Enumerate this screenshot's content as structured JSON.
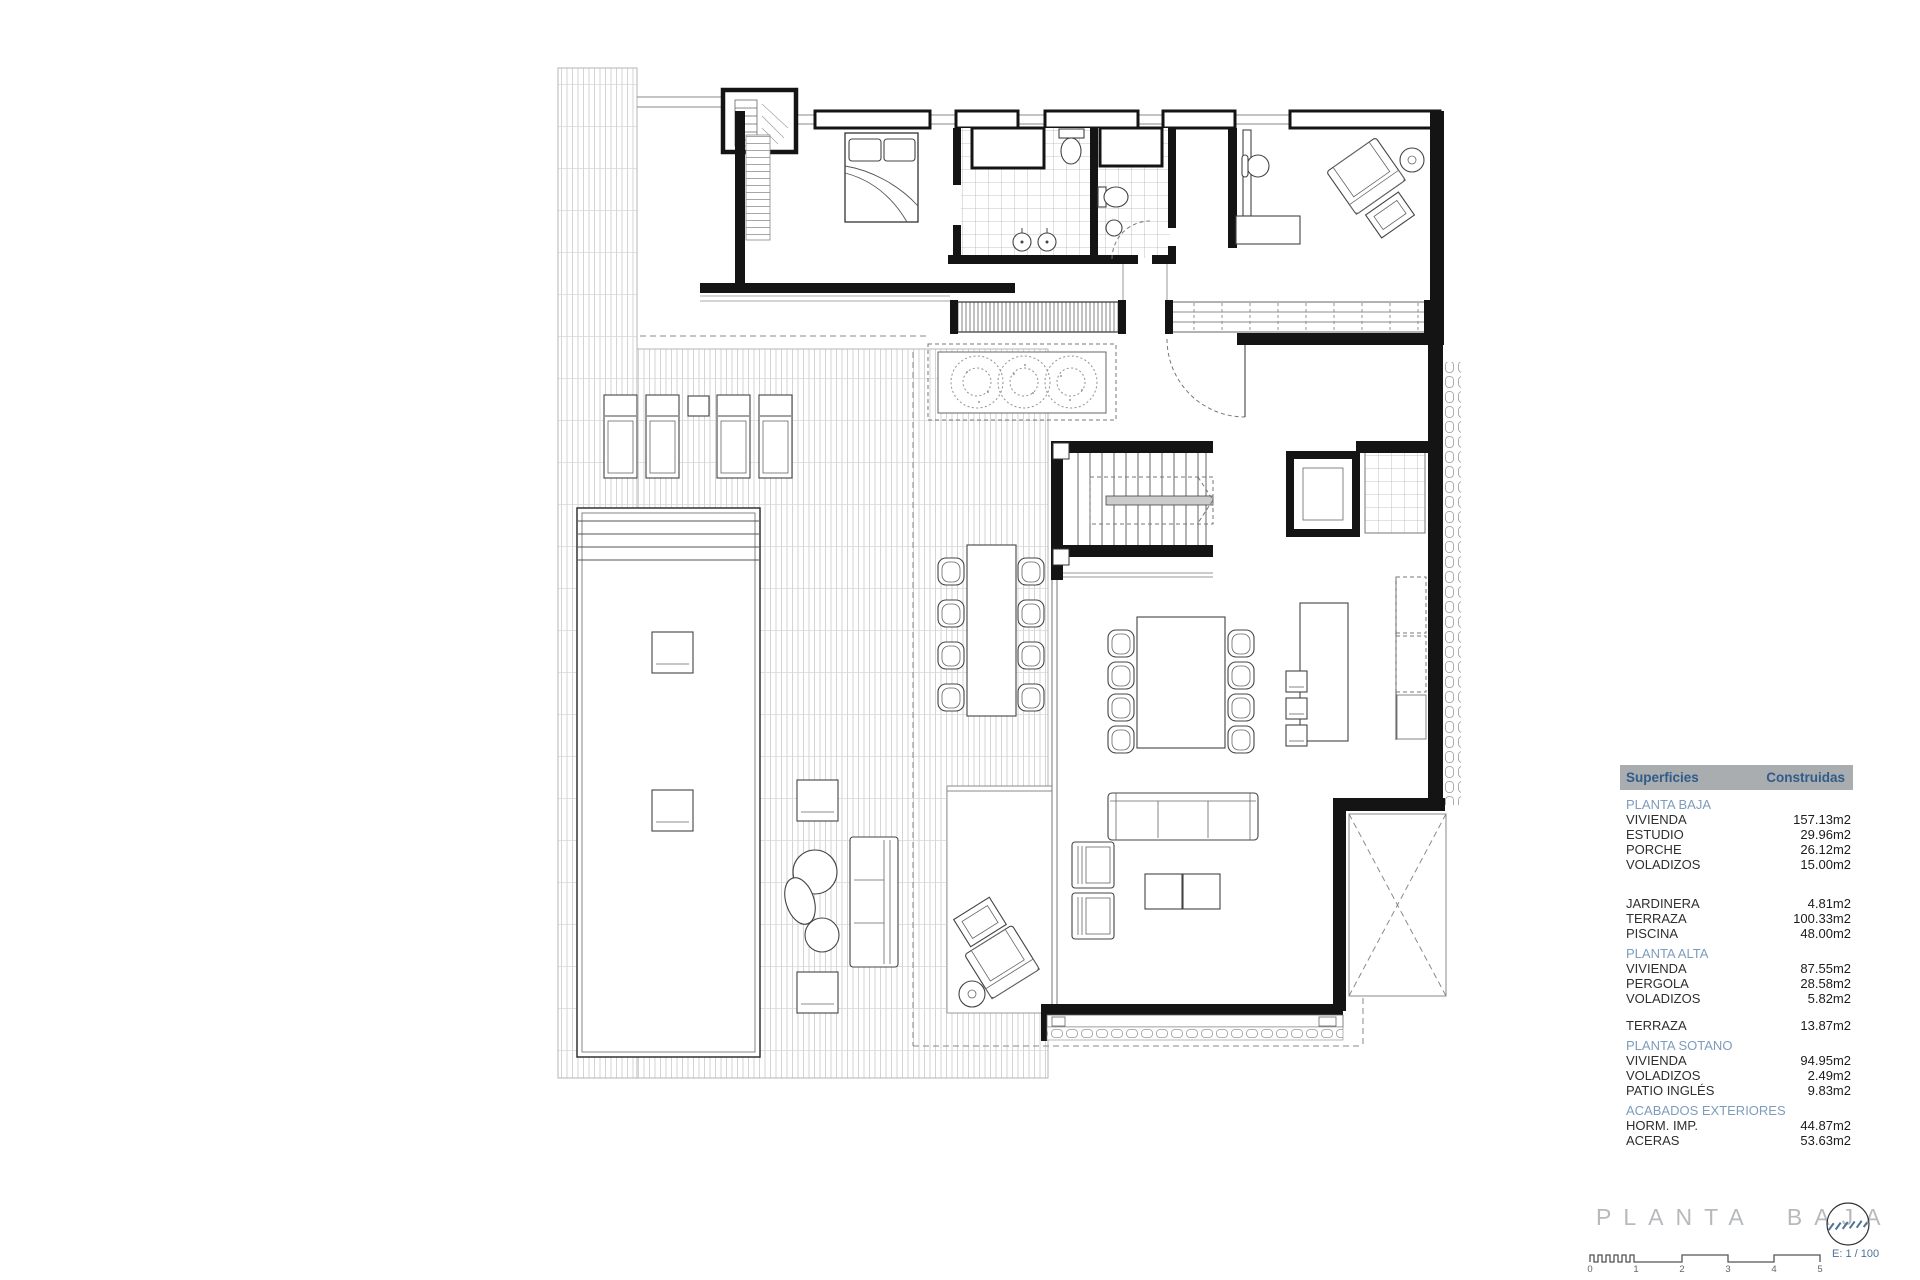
{
  "title_block": {
    "title": "PLANTA BAJA",
    "scale_label": "E: 1 / 100",
    "scale_ticks": [
      "0",
      "1",
      "2",
      "3",
      "4",
      "5"
    ]
  },
  "areas_table": {
    "header": {
      "col1": "Superficies",
      "col2": "Construidas"
    },
    "rows": [
      {
        "type": "section",
        "label": "PLANTA BAJA"
      },
      {
        "type": "row",
        "label": "VIVIENDA",
        "value": "157.13m2"
      },
      {
        "type": "row",
        "label": "ESTUDIO",
        "value": "29.96m2"
      },
      {
        "type": "row",
        "label": "PORCHE",
        "value": "26.12m2"
      },
      {
        "type": "row",
        "label": "VOLADIZOS",
        "value": "15.00m2"
      },
      {
        "type": "spacer",
        "label": "",
        "value": ""
      },
      {
        "type": "row",
        "label": "JARDINERA",
        "value": "4.81m2"
      },
      {
        "type": "row",
        "label": "TERRAZA",
        "value": "100.33m2"
      },
      {
        "type": "row",
        "label": "PISCINA",
        "value": "48.00m2"
      },
      {
        "type": "section",
        "label": "PLANTA ALTA"
      },
      {
        "type": "row",
        "label": "VIVIENDA",
        "value": "87.55m2"
      },
      {
        "type": "row",
        "label": "PERGOLA",
        "value": "28.58m2"
      },
      {
        "type": "row",
        "label": "VOLADIZOS",
        "value": "5.82m2"
      },
      {
        "type": "spacer-sm",
        "label": "",
        "value": ""
      },
      {
        "type": "row",
        "label": "TERRAZA",
        "value": "13.87m2"
      },
      {
        "type": "section",
        "label": "PLANTA SOTANO"
      },
      {
        "type": "row",
        "label": "VIVIENDA",
        "value": "94.95m2"
      },
      {
        "type": "row",
        "label": "VOLADIZOS",
        "value": "2.49m2"
      },
      {
        "type": "row",
        "label": "PATIO INGLÉS",
        "value": "9.83m2"
      },
      {
        "type": "section",
        "label": "ACABADOS EXTERIORES"
      },
      {
        "type": "row",
        "label": "HORM. IMP.",
        "value": "44.87m2"
      },
      {
        "type": "row",
        "label": "ACERAS",
        "value": "53.63m2"
      }
    ]
  },
  "colors": {
    "header_bg": "#a9adb0",
    "header_text": "#2f5c88",
    "section_text": "#7d9cbc",
    "row_text": "#2e2e2e",
    "value_text": "#1c1c1c",
    "title_text": "#b7babd",
    "scale_text": "#4d7296",
    "tick_text": "#666666",
    "wall": "#141414"
  }
}
